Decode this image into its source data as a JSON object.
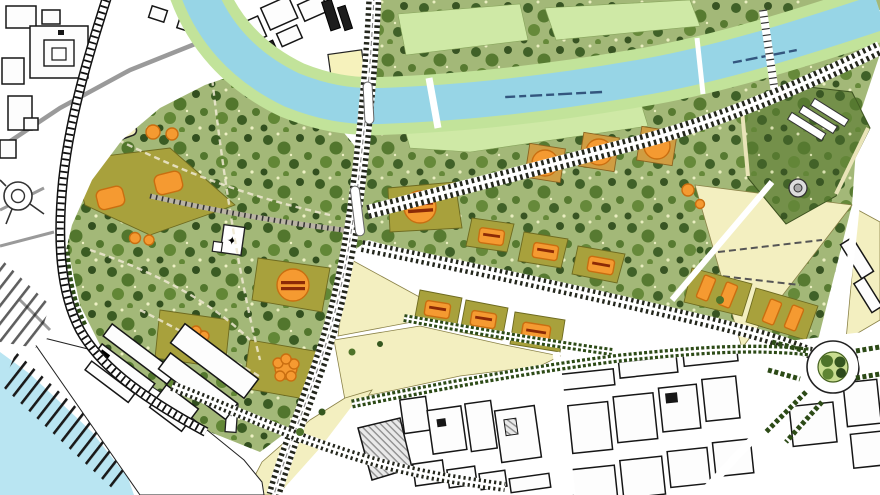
{
  "colors": {
    "water": "#97d5e6",
    "water_port": "#b9e5f2",
    "bank": "#c2e39a",
    "lawn": "#cfe9a6",
    "park": "#a3b878",
    "parcel": "#a8a13c",
    "parcel_tan": "#cf9d42",
    "orange": "#f59a31",
    "orange_edge": "#c96e10",
    "bar_red": "#8c2a06",
    "cream": "#f3efc0",
    "garden": "#74904a",
    "road_dark": "#23261c",
    "road_grey": "#9a9a9a",
    "hedge": "#2c4a16",
    "city_line": "#161616",
    "tree_dark": "#35571f",
    "tree_mid": "#4e7329",
    "tree_dark2": "#2c491a",
    "tree_mid2": "#5f8433",
    "dot_pale": "#f2f4c8",
    "label_blue": "#33567e",
    "roundabout_green": "#c9dd90"
  },
  "glyphs": {
    "monument_star": "✦"
  }
}
